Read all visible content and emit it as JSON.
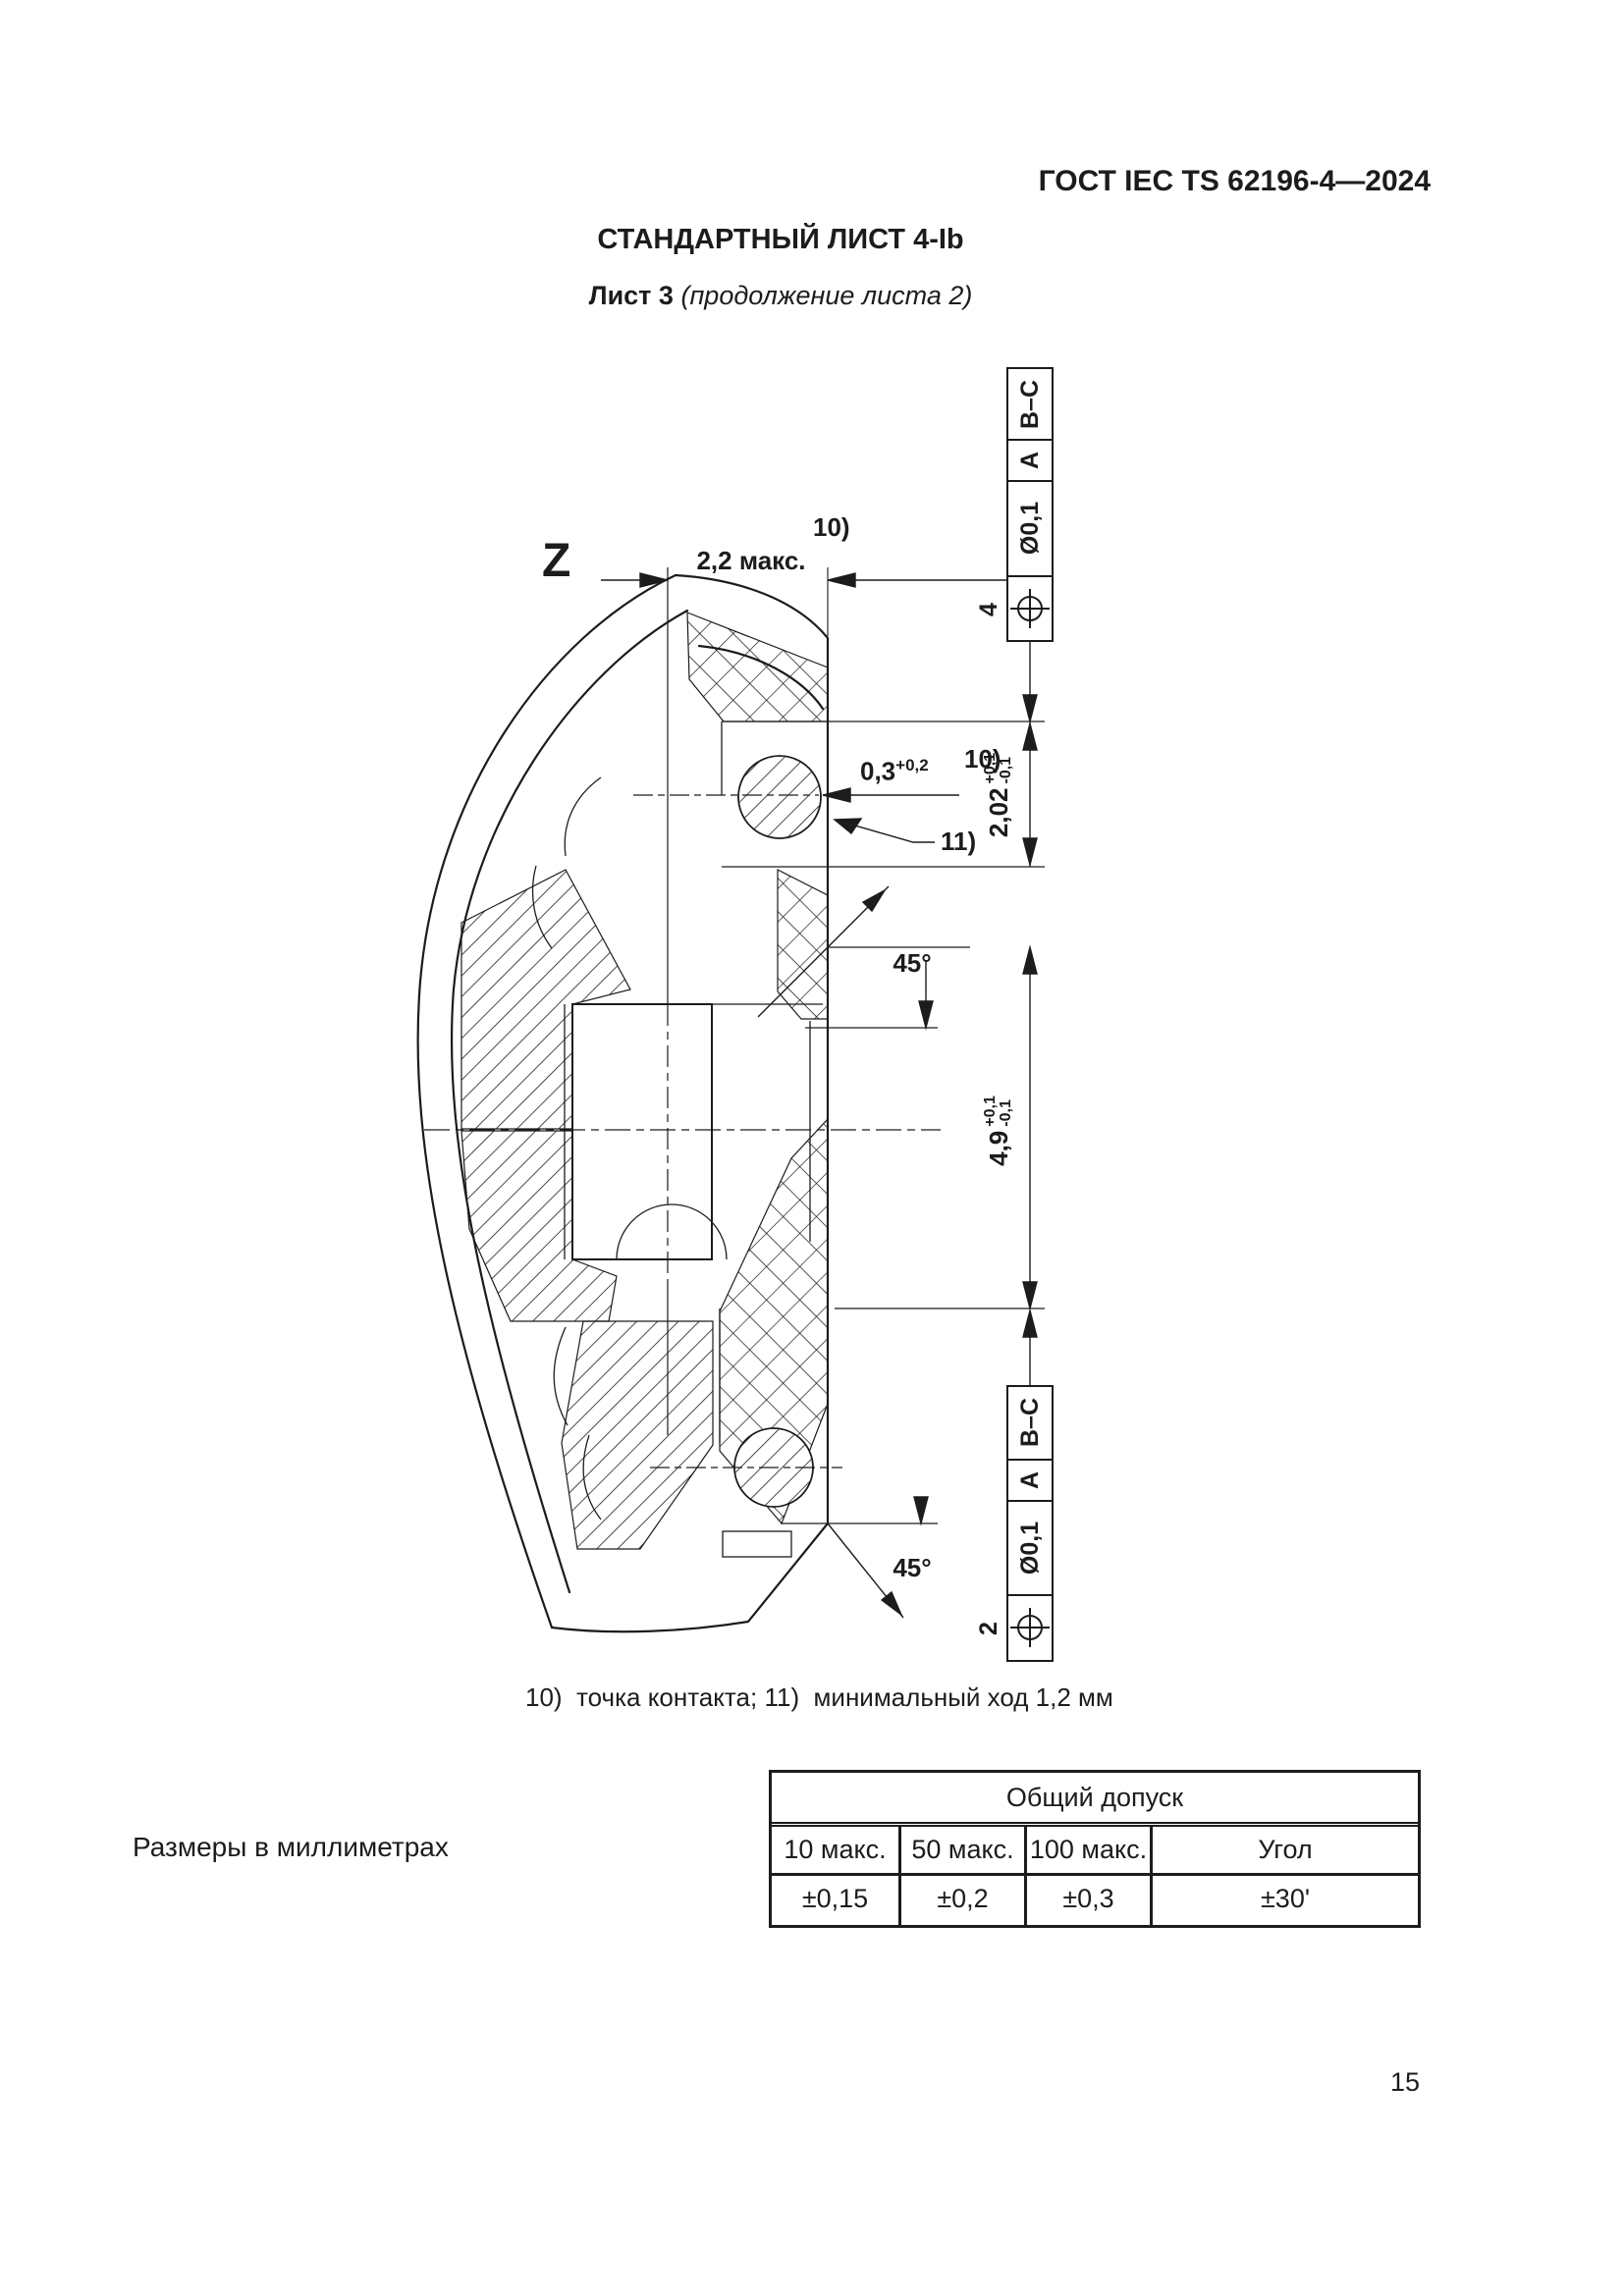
{
  "header": {
    "doc_code": "ГОСТ IEC TS 62196-4—2024"
  },
  "title": "СТАНДАРТНЫЙ ЛИСТ 4-Ib",
  "subtitle": {
    "sheet": "Лист 3",
    "continuation": "(продолжение листа 2)"
  },
  "drawing": {
    "view_label": "Z",
    "dim_width_max": "2,2 макс.",
    "note_10": "10)",
    "note_11": "11)",
    "dim_contact": {
      "base": "0,3",
      "sup": "+0,2"
    },
    "dim_height_contact": {
      "base": "2,02",
      "plus": "+0,1",
      "minus": "-0,1"
    },
    "dim_height_total": {
      "base": "4,9",
      "plus": "+0,1",
      "minus": "-0,1"
    },
    "angle_top": "45°",
    "angle_bottom": "45°",
    "fcf_top": {
      "item": "4",
      "tolerance": "Ø0,1",
      "datum1": "A",
      "datum2": "B–C"
    },
    "fcf_bottom": {
      "item": "2",
      "tolerance": "Ø0,1",
      "datum1": "A",
      "datum2": "B–C"
    },
    "footnote": "10)  точка контакта; 11)  минимальный ход 1,2 мм"
  },
  "dimensions_note": "Размеры в миллиметрах",
  "tolerance_table": {
    "title": "Общий допуск",
    "columns": [
      "10 макс.",
      "50 макс.",
      "100 макс.",
      "Угол"
    ],
    "values": [
      "±0,15",
      "±0,2",
      "±0,3",
      "±30'"
    ]
  },
  "page_number": "15"
}
